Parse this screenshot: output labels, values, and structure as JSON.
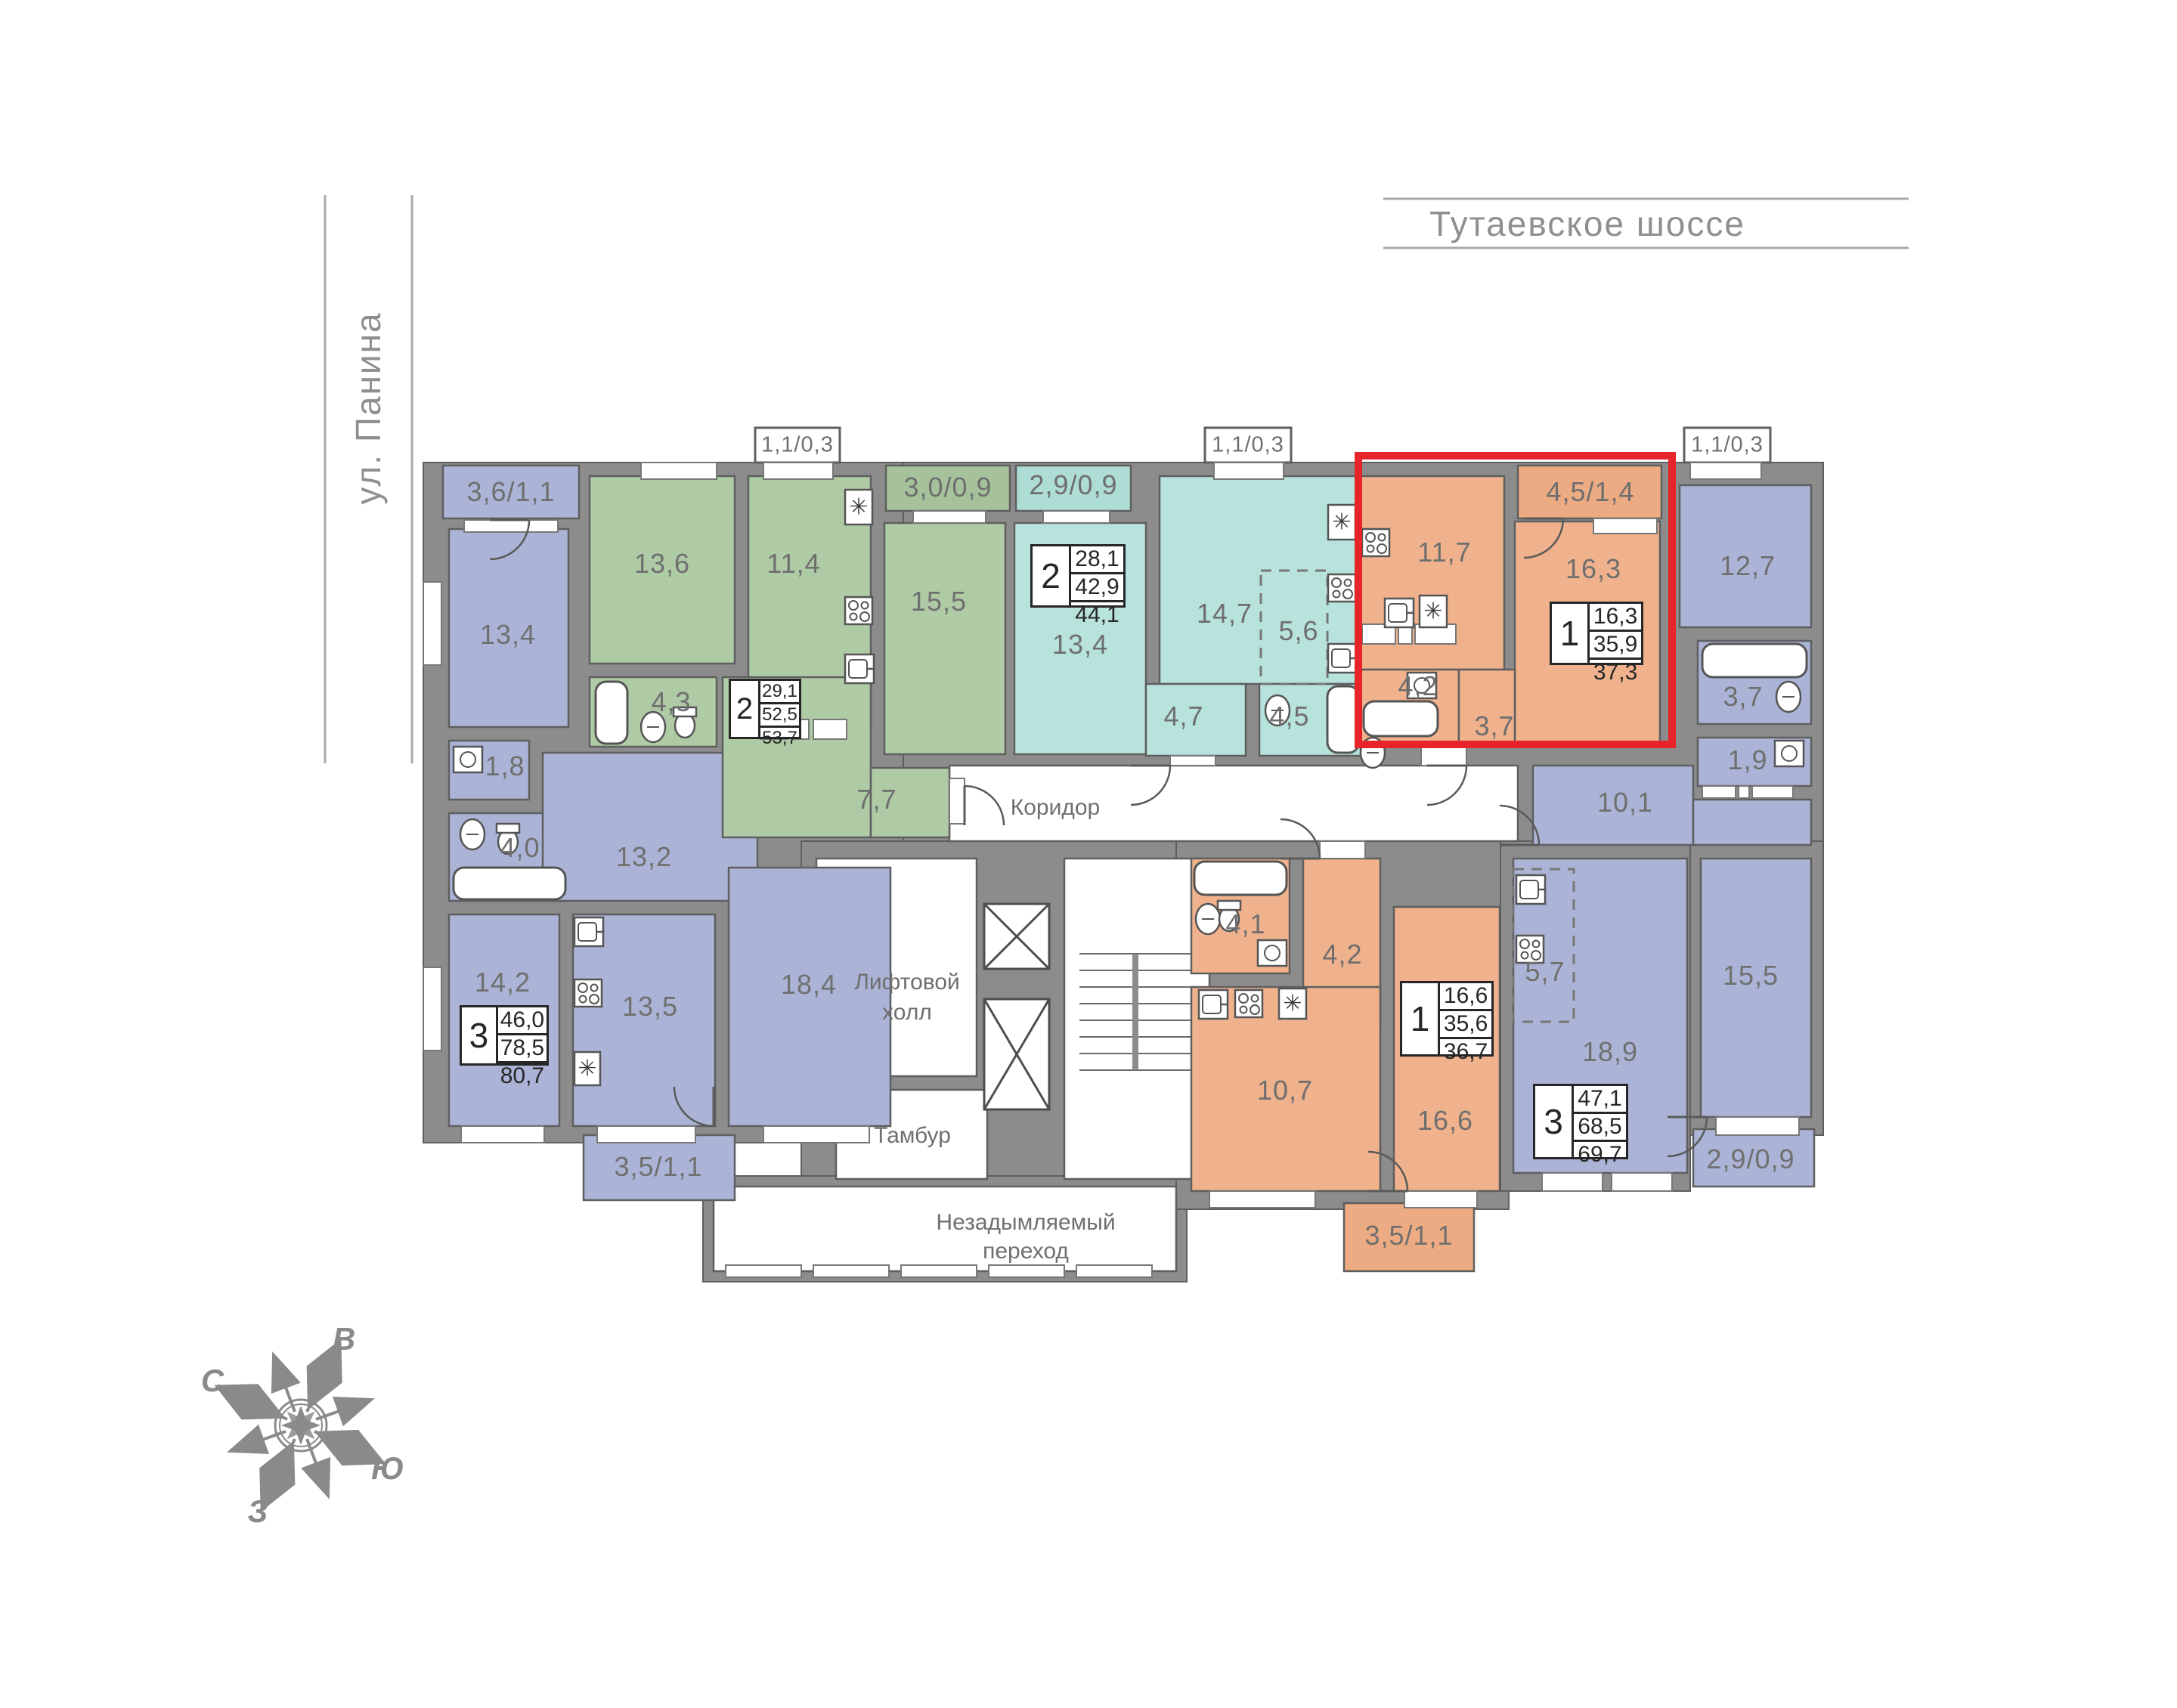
{
  "streets": {
    "top": "Тутаевское шоссе",
    "left": "ул. Панина"
  },
  "common_areas": {
    "corridor": "Коридор",
    "elevator_hall_line1": "Лифтовой",
    "elevator_hall_line2": "холл",
    "vestibule": "Тамбур",
    "passage_line1": "Незадымляемый",
    "passage_line2": "переход"
  },
  "compass": {
    "north": "С",
    "east": "В",
    "south": "Ю",
    "west": "З"
  },
  "icons": {
    "fridge": "✳"
  },
  "colors": {
    "blue": "#abb4d6",
    "green": "#afcba6",
    "teal": "#b8e3dc",
    "orange": "#efb28c",
    "highlight": "#e62429",
    "wall": "#8c8c8c"
  },
  "apartments": {
    "left3": {
      "type": "3",
      "spec": {
        "living": "46,0",
        "area": "78,5",
        "total": "80,7"
      },
      "rooms": {
        "balcony_top": "3,6/1,1",
        "bedroom1": "13,4",
        "wc": "1,8",
        "bath": "4,0",
        "hall": "13,2",
        "bedroom2": "14,2",
        "kitchen": "13,5",
        "living": "18,4",
        "balcony_bottom": "3,5/1,1"
      }
    },
    "green2": {
      "type": "2",
      "spec": {
        "living": "29,1",
        "area": "52,5",
        "total": "53,7"
      },
      "rooms": {
        "bedroom": "13,6",
        "kitchen": "11,4",
        "balcony_small": "1,1/0,3",
        "balcony": "3,0/0,9",
        "living": "15,5",
        "bath": "4,3",
        "hall": "7,7"
      }
    },
    "teal2": {
      "type": "2",
      "spec": {
        "living": "28,1",
        "area": "42,9",
        "total": "44,1"
      },
      "rooms": {
        "balcony": "2,9/0,9",
        "bedroom": "13,4",
        "living": "14,7",
        "kitchen": "5,6",
        "balcony_small": "1,1/0,3",
        "hall": "4,7",
        "bath": "4,5"
      }
    },
    "red1": {
      "type": "1",
      "highlighted": true,
      "spec": {
        "living": "16,3",
        "area": "35,9",
        "total": "37,3"
      },
      "rooms": {
        "kitchen": "11,7",
        "balcony": "4,5/1,4",
        "living": "16,3",
        "bath": "4,2",
        "hall": "3,7"
      }
    },
    "right3": {
      "type": "3",
      "spec": {
        "living": "47,1",
        "area": "68,5",
        "total": "69,7"
      },
      "rooms": {
        "balcony_small": "1,1/0,3",
        "bedroom1": "12,7",
        "bath": "3,7",
        "wc": "1,9",
        "hall": "10,1",
        "kitchen": "5,7",
        "living": "18,9",
        "bedroom2": "15,5",
        "balcony": "2,9/0,9"
      }
    },
    "orange1": {
      "type": "1",
      "spec": {
        "living": "16,6",
        "area": "35,6",
        "total": "36,7"
      },
      "rooms": {
        "bath": "4,1",
        "hall": "4,2",
        "kitchen": "10,7",
        "living": "16,6",
        "balcony": "3,5/1,1"
      }
    }
  }
}
